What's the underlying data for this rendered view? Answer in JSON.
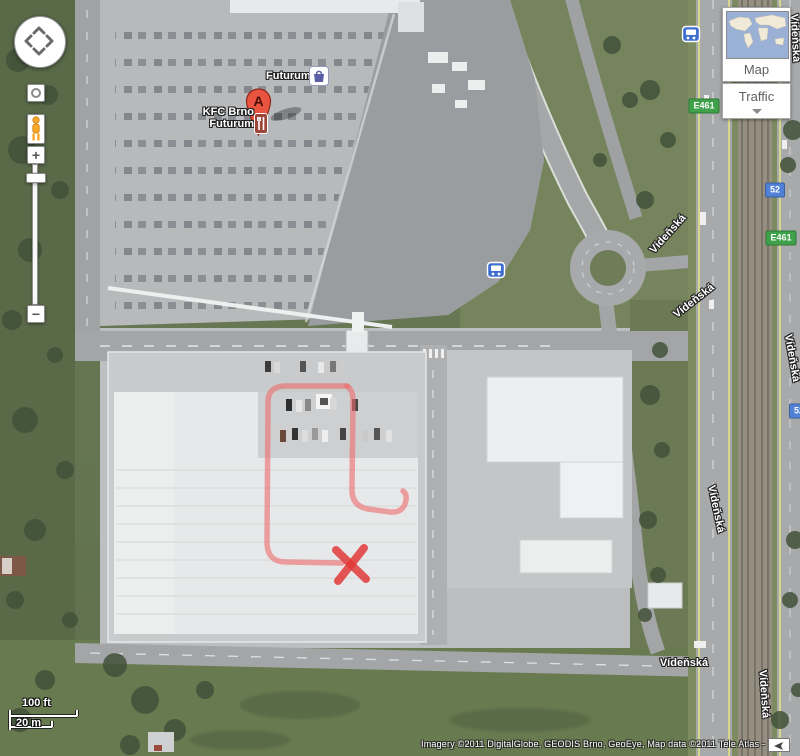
{
  "controls": {
    "zoom_in": "+",
    "zoom_out": "−",
    "map_button": "Map",
    "traffic_button": "Traffic"
  },
  "poi": {
    "marker_letter": "A",
    "kfc_line1": "KFC Brno",
    "kfc_line2": "Futurum",
    "futurum_label": "Futurum"
  },
  "road_labels": [
    {
      "text": "Vídeňská"
    },
    {
      "text": "Vídeňská"
    },
    {
      "text": "Vídeňská"
    },
    {
      "text": "Vídeňská"
    },
    {
      "text": "Vídeňská"
    },
    {
      "text": "Vídeňská"
    },
    {
      "text": "Vídeňská"
    }
  ],
  "shields": [
    {
      "text": "E461"
    },
    {
      "text": "52"
    },
    {
      "text": "E461"
    },
    {
      "text": "52"
    }
  ],
  "scale": {
    "imperial": "100 ft",
    "metric": "20 m"
  },
  "attribution": "Imagery ©2011 DigitalGlobe, GEODIS Brno, GeoEye, Map data ©2011 Tele Atlas -",
  "colors": {
    "marker_red": "#e8543f",
    "annotation_red": "#ef6a6a",
    "annotation_x_red": "#e03a3a",
    "shield_green": "#3fa24b",
    "shield_blue": "#5181d6",
    "transit_blue": "#3f6fd1",
    "thumbnail_ocean_blue": "#9ab0d4"
  }
}
